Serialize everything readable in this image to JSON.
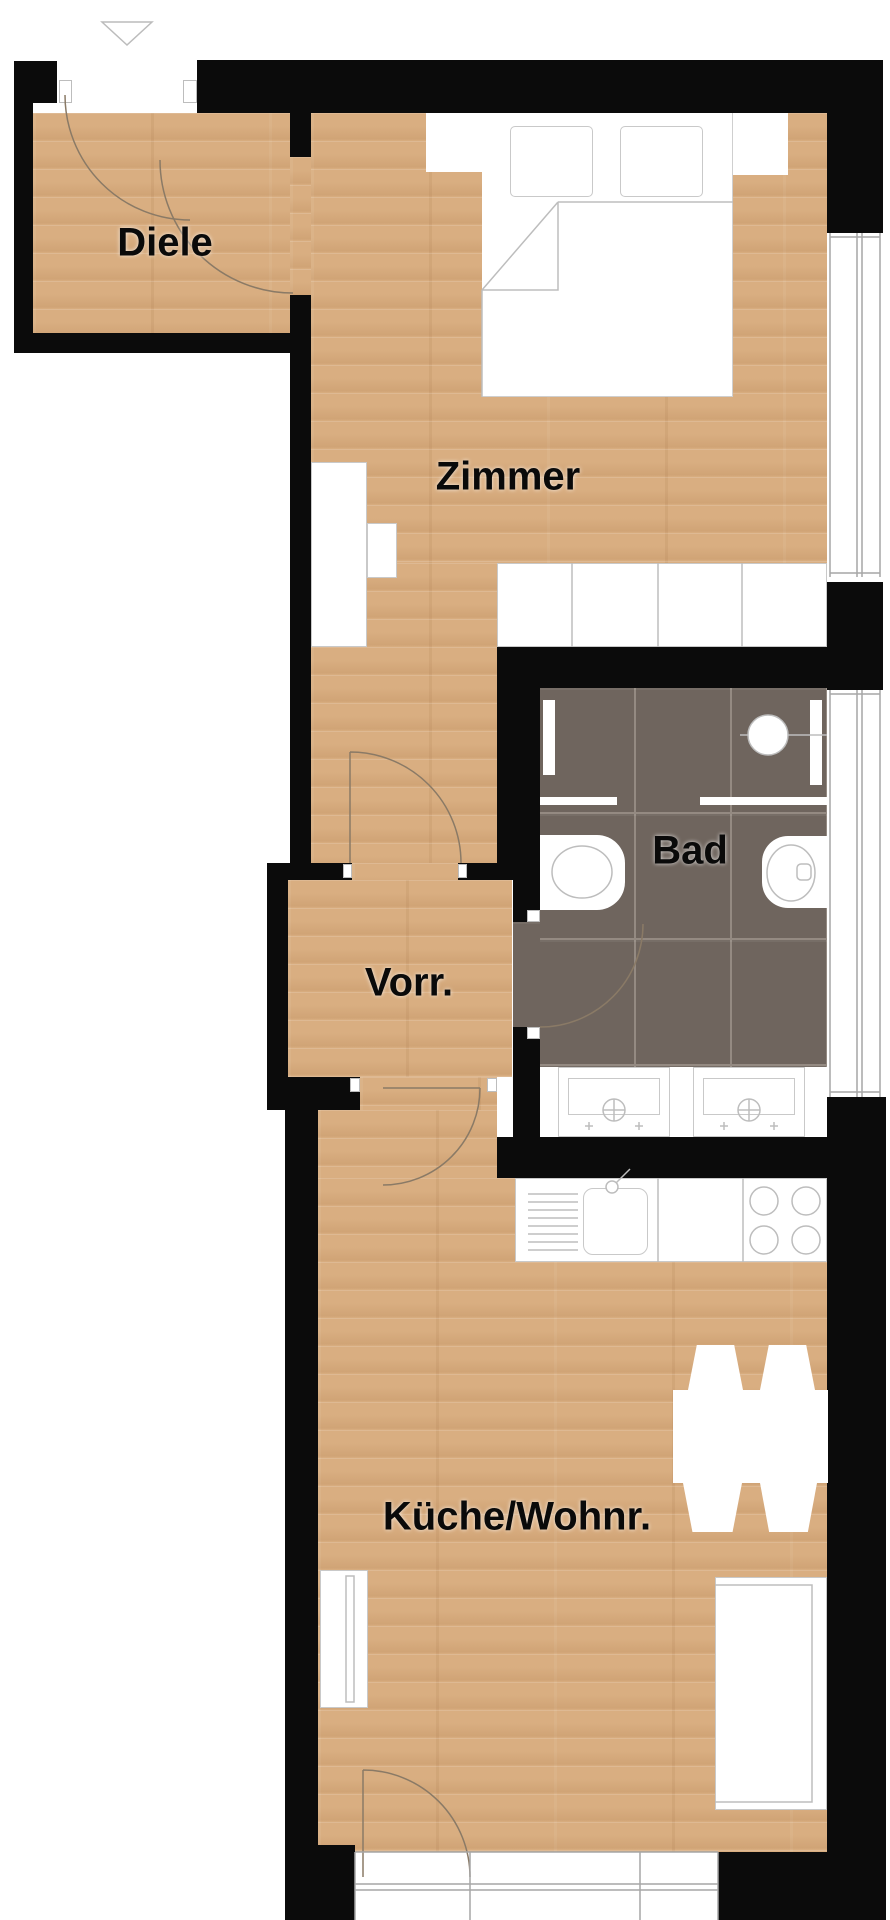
{
  "plan": {
    "type": "apartment-floor-plan",
    "rooms": [
      {
        "id": "diele",
        "label": "Diele"
      },
      {
        "id": "zimmer",
        "label": "Zimmer"
      },
      {
        "id": "bad",
        "label": "Bad"
      },
      {
        "id": "vorraum",
        "label": "Vorr."
      },
      {
        "id": "kueche-wohnraum",
        "label": "Küche/Wohnr."
      }
    ],
    "icons": {
      "entrance_arrow": "triangle-down-outline"
    },
    "colors": {
      "wall": "#0b0b0b",
      "wood_floor": "#d9ae81",
      "bathroom_tile": "#6f655e",
      "tile_grout": "#948a82",
      "fixture_outline": "#bdbdbd",
      "door_arc": "#8a7a66",
      "label_text": "#0a0a0a",
      "background": "#ffffff"
    }
  }
}
